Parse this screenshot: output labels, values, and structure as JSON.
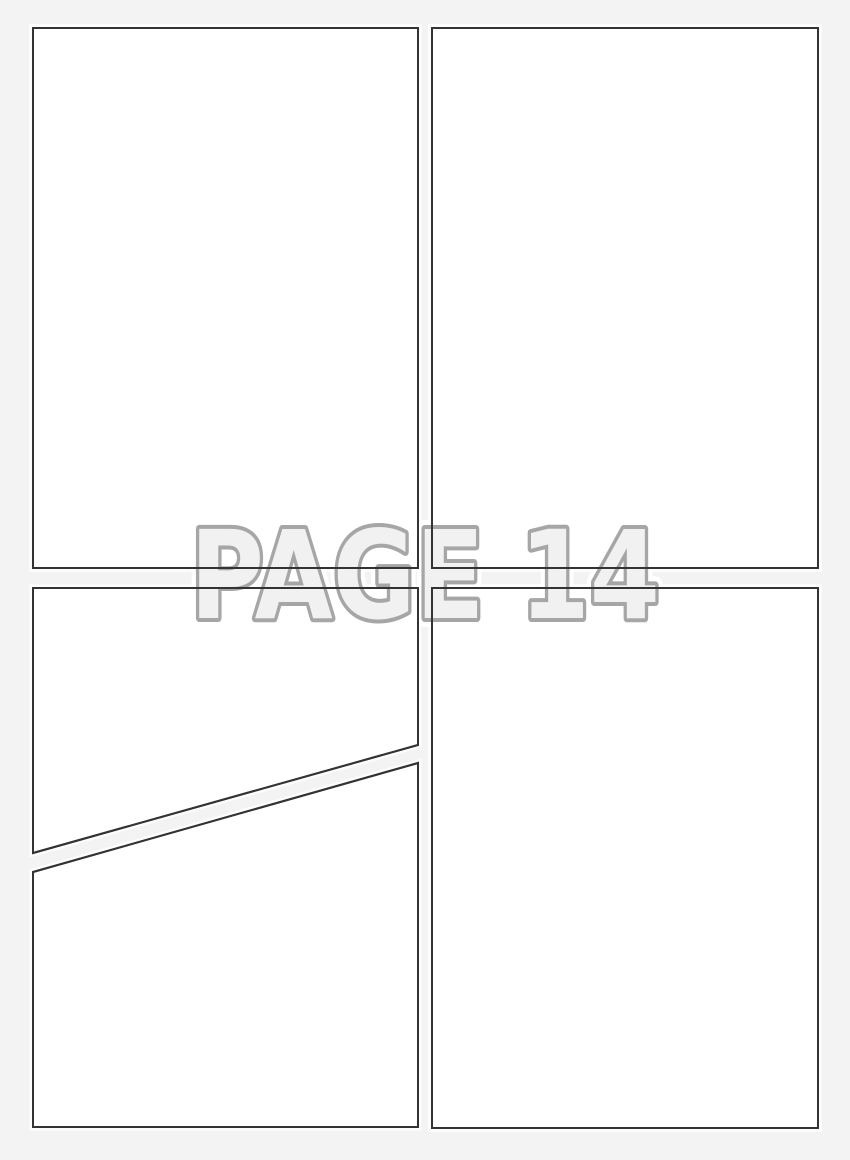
{
  "page_label": "PAGE 14",
  "colors": {
    "background": "#f3f3f3",
    "panel_fill": "#ffffff",
    "panel_border": "#333333",
    "label_fill": "#f1f1f1",
    "label_outline": "#a6a6a6",
    "label_halo": "#ffffff"
  },
  "panels": [
    {
      "id": "top-left"
    },
    {
      "id": "top-right"
    },
    {
      "id": "bottom-left-upper"
    },
    {
      "id": "bottom-left-lower"
    },
    {
      "id": "bottom-right"
    }
  ]
}
